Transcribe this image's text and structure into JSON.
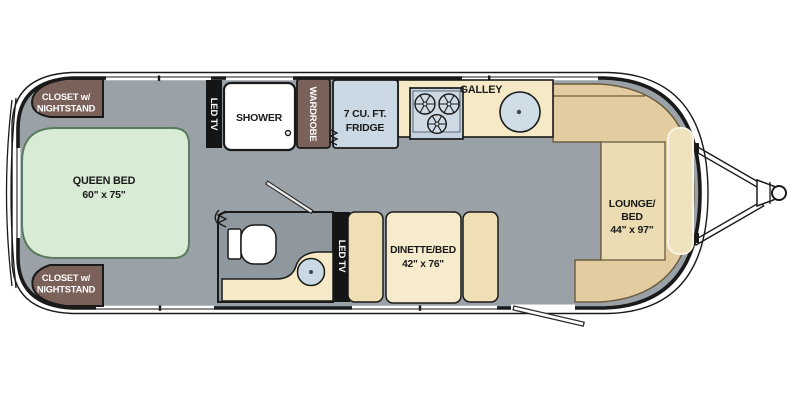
{
  "type": "travel-trailer-floorplan",
  "labels": {
    "closet_top": {
      "line1": "CLOSET w/",
      "line2": "NIGHTSTAND"
    },
    "closet_bottom": {
      "line1": "CLOSET w/",
      "line2": "NIGHTSTAND"
    },
    "queen_bed": {
      "line1": "QUEEN BED",
      "line2": "60\" x 75\""
    },
    "led_tv_bedroom": "LED TV",
    "shower": "SHOWER",
    "wardrobe": "WARDROBE",
    "fridge": {
      "line1": "7 CU. FT.",
      "line2": "FRIDGE"
    },
    "galley": "GALLEY",
    "led_tv_dinette": "LED TV",
    "dinette": {
      "line1": "DINETTE/BED",
      "line2": "42\" x 76\""
    },
    "lounge": {
      "line1": "LOUNGE/",
      "line2": "BED",
      "line3": "44\" x 97\""
    }
  },
  "colors": {
    "floor": "#9AA2A7",
    "bathroom_floor": "#8F989E",
    "bed_fill": "#D8EBD4",
    "bed_border": "#5B7B60",
    "closet_brown": "#7A615A",
    "counter_tan": "#F6E9C6",
    "dinette_seat": "#F0DFB5",
    "dinette_table": "#F6EBCC",
    "lounge_tan": "#E3CDA0",
    "lounge_seat": "#EBDCB4",
    "appliance_blue": "#CBD9E4",
    "tv_black": "#151515",
    "outline": "#1A1A1A"
  }
}
